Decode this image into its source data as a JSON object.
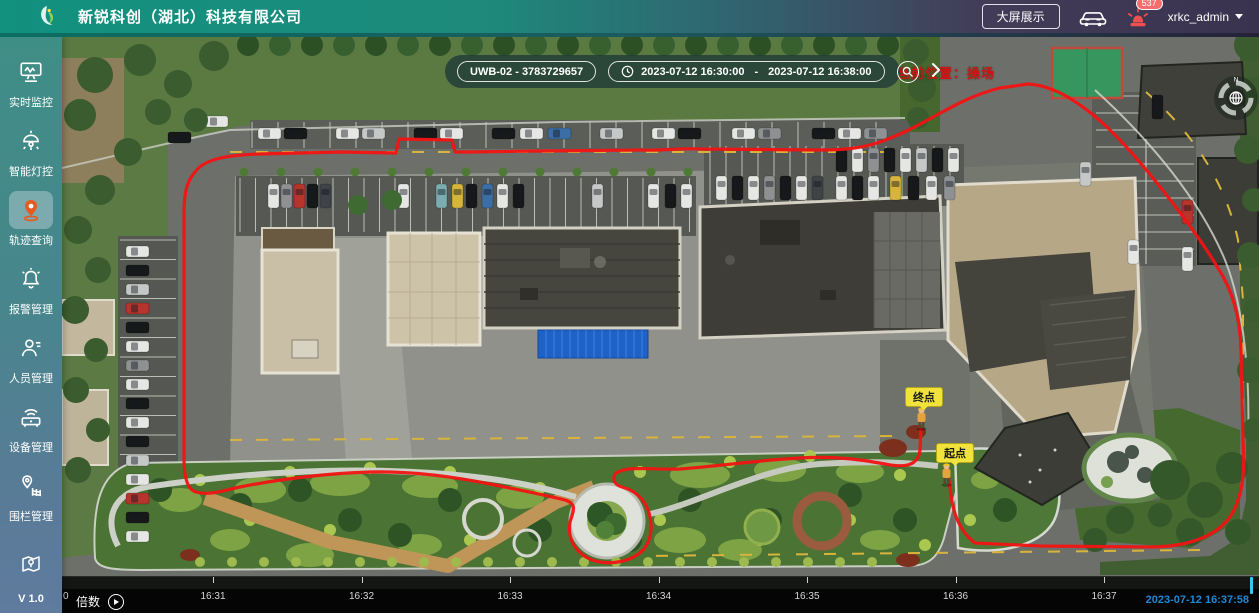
{
  "header": {
    "company_name": "新锐科创（湖北）科技有限公司",
    "big_screen_button": "大屏展示",
    "alarm_badge": "537",
    "username": "xrkc_admin"
  },
  "sidebar": {
    "items": [
      {
        "label": "实时监控"
      },
      {
        "label": "智能灯控"
      },
      {
        "label": "轨迹查询"
      },
      {
        "label": "报警管理"
      },
      {
        "label": "人员管理"
      },
      {
        "label": "设备管理"
      },
      {
        "label": "围栏管理"
      }
    ],
    "version": "V 1.0"
  },
  "map": {
    "search": {
      "device_value": "UWB-02 - 3783729657",
      "time_start": "2023-07-12 16:30:00",
      "time_separator": "-",
      "time_end": "2023-07-12 16:38:00"
    },
    "overlay": {
      "current_location": "当前位置：操场",
      "end_marker": "终点",
      "start_marker": "起点"
    },
    "colors": {
      "trajectory": "#f21313",
      "marker_bg": "#f2e33c"
    }
  },
  "timeline": {
    "speed_label": "倍数",
    "left_partial_label": "0",
    "ticks": [
      "16:31",
      "16:32",
      "16:33",
      "16:34",
      "16:35",
      "16:36",
      "16:37"
    ],
    "current_time": "2023-07-12 16:37:58",
    "accent_color": "#39c6f2"
  }
}
